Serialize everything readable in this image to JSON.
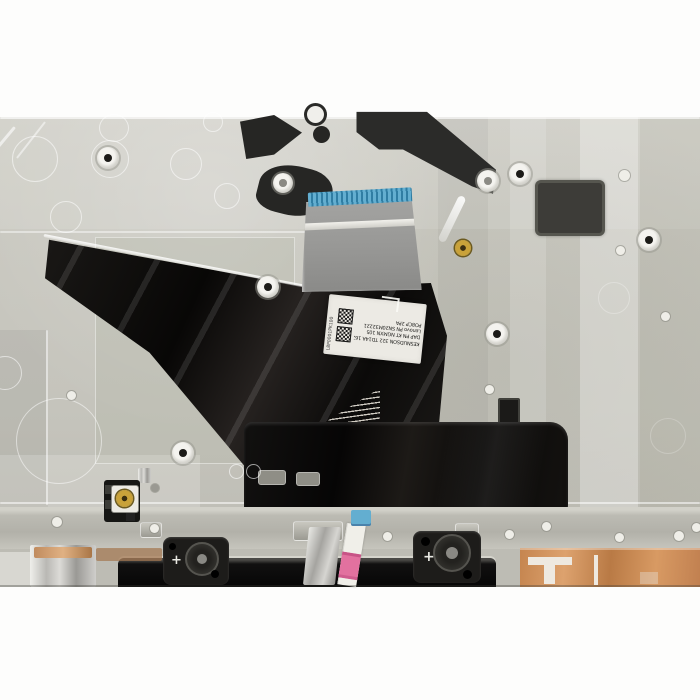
{
  "scene": {
    "type": "product-photo",
    "subject": "Laptop palmrest / keyboard assembly photographed from the internal rear side on a white background, showing the keyboard flex ribbon cable with blue contact fingers, a rotated white part label with two QR codes, black adhesive pads, screw holes, touchpad mounting brackets, a small blue/pink touchpad FFC cable, copper foil shielding and a gold RF coax connector"
  },
  "colors": {
    "plate_gray": "#c9c8c0",
    "gloss_black": "#141210",
    "ribbon_blue": "#63aed0",
    "ffc_pink": "#e2719f",
    "copper": "#c5854f",
    "gold": "#c9a23a",
    "label_white": "#eceae4",
    "background": "#fdfdfc"
  },
  "part_label": {
    "line1": "KESNUDSON 322 TD14A 1620068",
    "line2": "DAP PN KT NGMXN 105",
    "line3": "Lenovo PN SN20M32221",
    "line4": "PO8CP 2PA",
    "edge_text": "L8P0001PK100"
  },
  "markings": {
    "plus": "+"
  }
}
